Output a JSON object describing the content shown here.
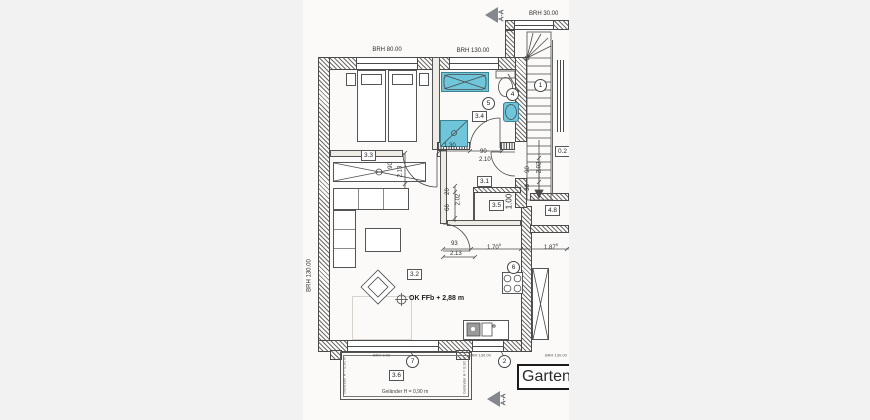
{
  "marker": {
    "section": "A-A"
  },
  "brh": {
    "stair": "BRH 30.00",
    "bedroom": "BRH 80.00",
    "bath": "BRH 130.00",
    "left_wall": "BRH 130.00",
    "balcony_door": "BRH 0.00",
    "kitchen_window": "BRH 130.00",
    "right_window": "BRH 130.00"
  },
  "rooms": {
    "bedroom": "3.3",
    "bath": "3.4",
    "hall": "3.1",
    "storage": "3.5",
    "living": "3.2",
    "balcony": "3.6",
    "neighbor": "4.8",
    "partial_right": "0.2"
  },
  "pos": {
    "n1": "1",
    "n2": "2",
    "n4": "4",
    "n5": "5",
    "n6": "6",
    "n7": "7"
  },
  "ann": {
    "ffb": "OK FFb + 2,88 m",
    "garten": "Garten",
    "gelaender": "Geländer H = 0,90 m"
  },
  "dims": {
    "w130": "1.30",
    "w90": "90",
    "h210": "2.10",
    "bd_w": "90",
    "bd_h": "2.13",
    "n20": "20",
    "n66": "66",
    "n202": "2.02",
    "s100": "1.00",
    "r90": "90",
    "r202": "2.02",
    "r38": "38",
    "d93": "93",
    "d213": "2.13",
    "d170": "1.70",
    "d170s": "5",
    "d187": "1.87",
    "d187s": "5"
  },
  "colors": {
    "fixture": "#6fc6da",
    "line": "#4a4a4a",
    "arrow": "#84878b",
    "paper": "#fbfaf8",
    "background": "#f2f2f3"
  }
}
